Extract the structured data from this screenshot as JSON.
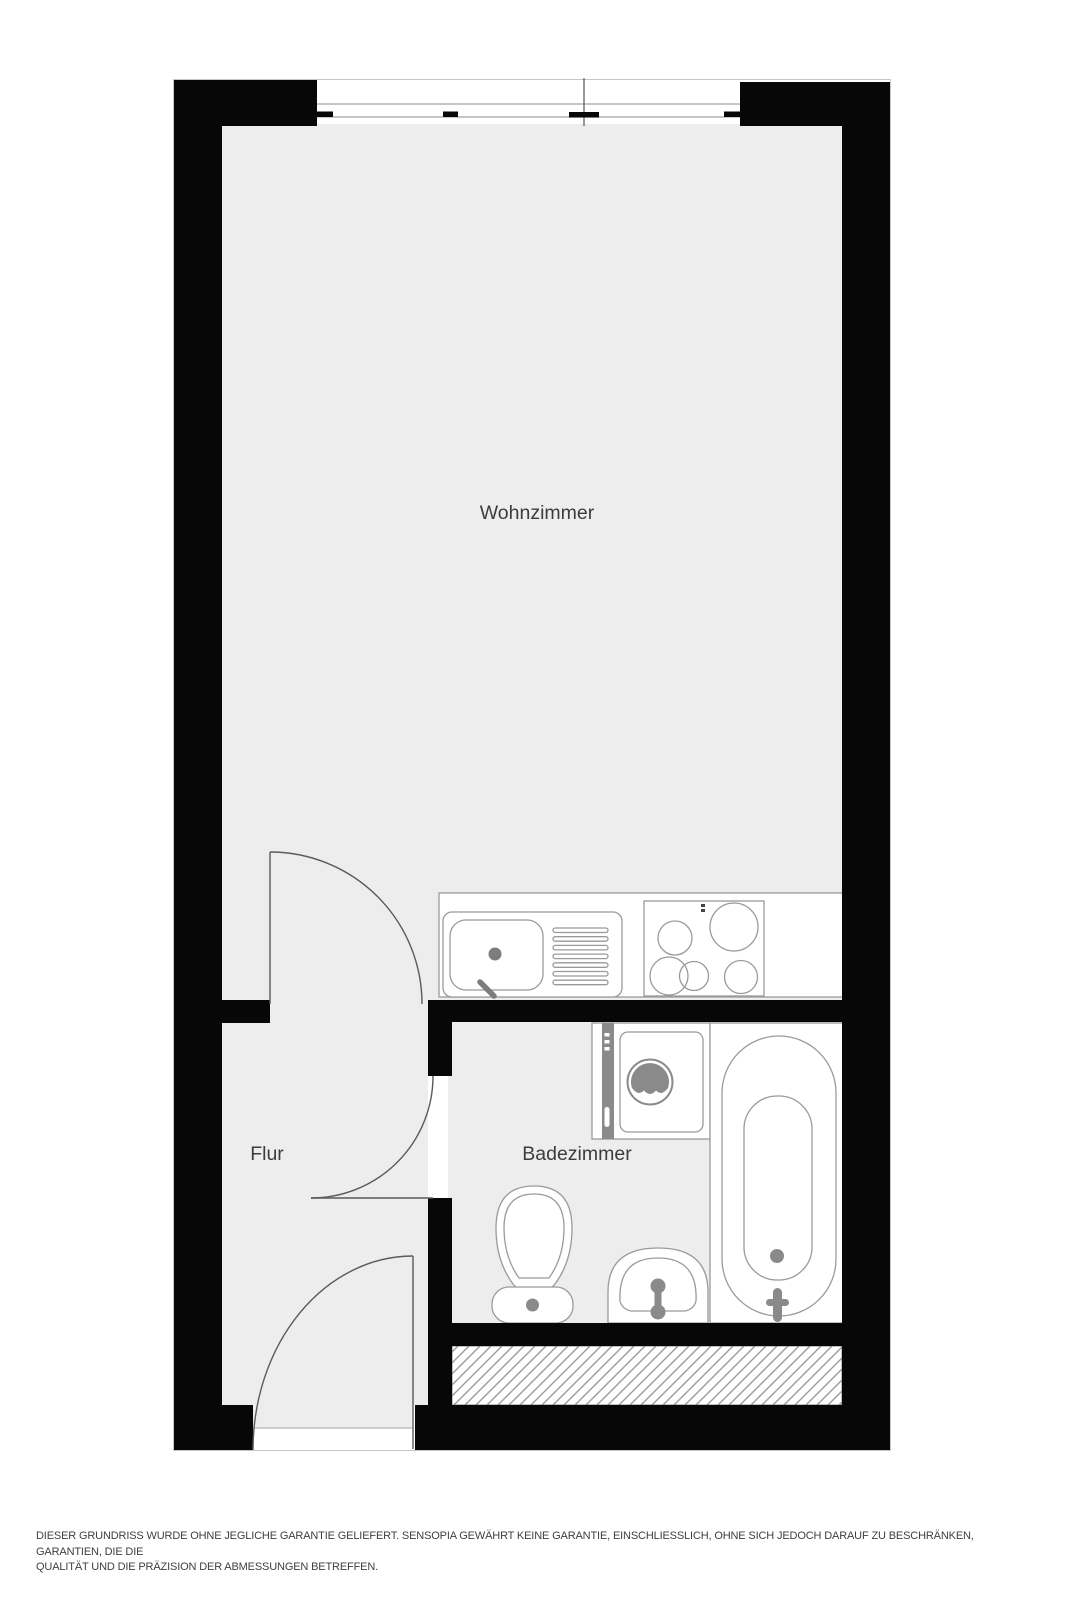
{
  "plan": {
    "type": "floor-plan",
    "rooms": {
      "living_room": {
        "label": "Wohnzimmer"
      },
      "hallway": {
        "label": "Flur"
      },
      "bathroom": {
        "label": "Badezimmer"
      }
    },
    "fixtures": [
      "window",
      "kitchen-counter",
      "kitchen-sink",
      "drainboard",
      "cooktop",
      "washing-machine",
      "bathtub",
      "toilet",
      "washbasin",
      "living-room-door",
      "bathroom-door",
      "entrance-door",
      "hatched-area"
    ],
    "colors": {
      "wall": "#070707",
      "floor": "#ededed",
      "fixture_outline": "#9a9a9a",
      "accent_gray": "#8a8a8a",
      "label_text": "#3c3c3c",
      "background": "#ffffff"
    }
  },
  "disclaimer": {
    "line1": "DIESER GRUNDRISS WURDE OHNE JEGLICHE GARANTIE GELIEFERT. SENSOPIA GEWÄHRT KEINE GARANTIE, EINSCHLIESSLICH, OHNE SICH JEDOCH DARAUF ZU BESCHRÄNKEN, GARANTIEN, DIE DIE",
    "line2": "QUALITÄT UND DIE PRÄZISION DER ABMESSUNGEN BETREFFEN."
  }
}
